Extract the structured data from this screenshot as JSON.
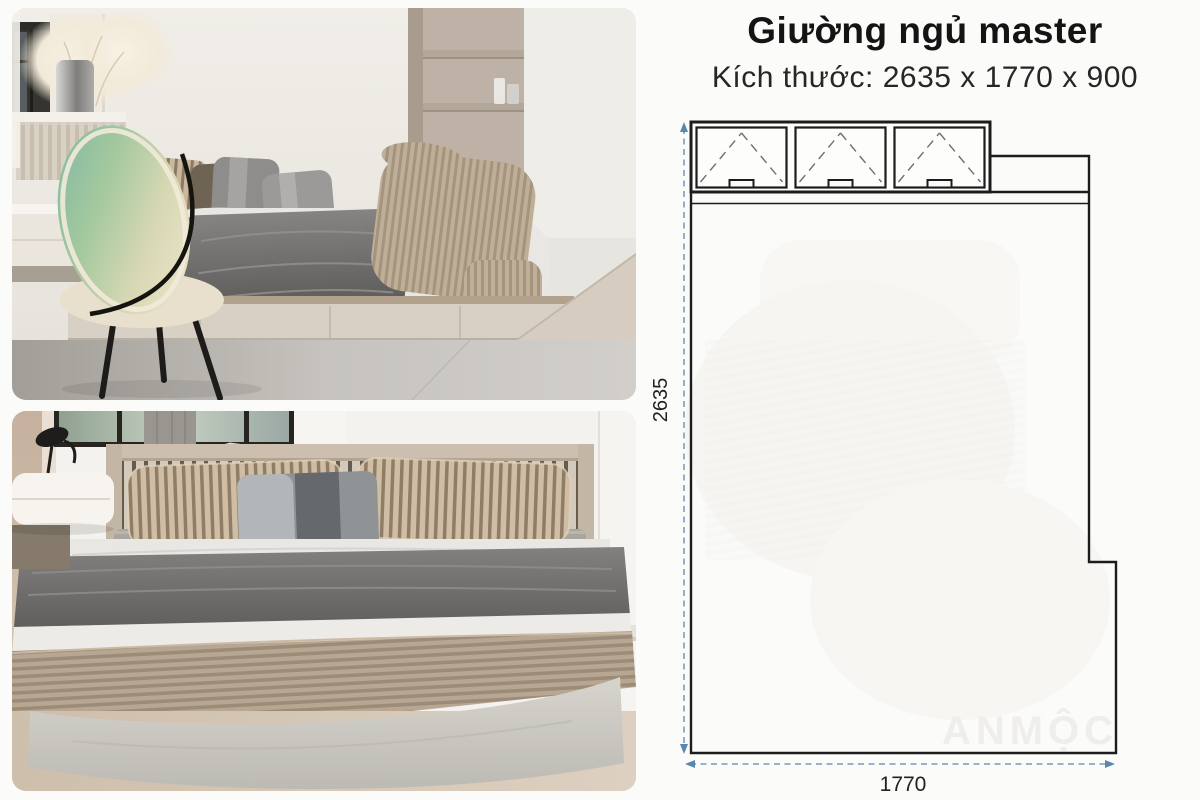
{
  "header": {
    "title": "Giường ngủ master",
    "subtitle": "Kích thước: 2635 x 1770 x 900"
  },
  "diagram": {
    "height_label": "2635",
    "width_label": "1770",
    "watermark": "ANMỘC",
    "colors": {
      "outline": "#1c1c1c",
      "dimension_line": "#5b87ae",
      "watermark": "#f0eeea"
    }
  }
}
